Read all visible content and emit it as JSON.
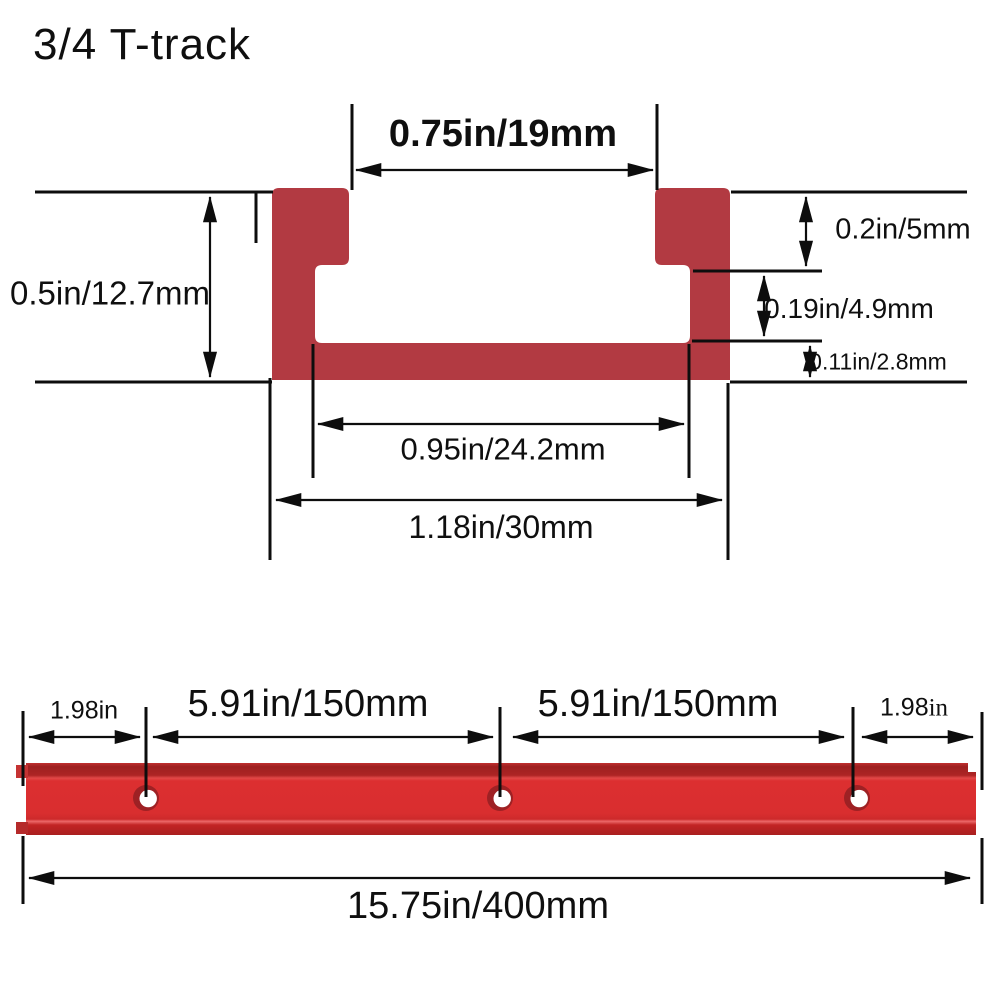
{
  "title": "3/4 T-track",
  "colors": {
    "profile": "#b23a42",
    "track_face": "#dc2f30",
    "line": "#0d0d0d"
  },
  "cross_section": {
    "top_opening": "0.75in/19mm",
    "height": "0.5in/12.7mm",
    "lip_depth": "0.2in/5mm",
    "side_gap": "0.19in/4.9mm",
    "base_thickness": "0.11in/2.8mm",
    "inner_width": "0.95in/24.2mm",
    "outer_width": "1.18in/30mm"
  },
  "length_view": {
    "left_end_offset": "1.98in",
    "hole_spacing_1": "5.91in/150mm",
    "hole_spacing_2": "5.91in/150mm",
    "right_end_offset_value": "1.98",
    "right_end_offset_unit": "in",
    "total_length": "15.75in/400mm"
  }
}
